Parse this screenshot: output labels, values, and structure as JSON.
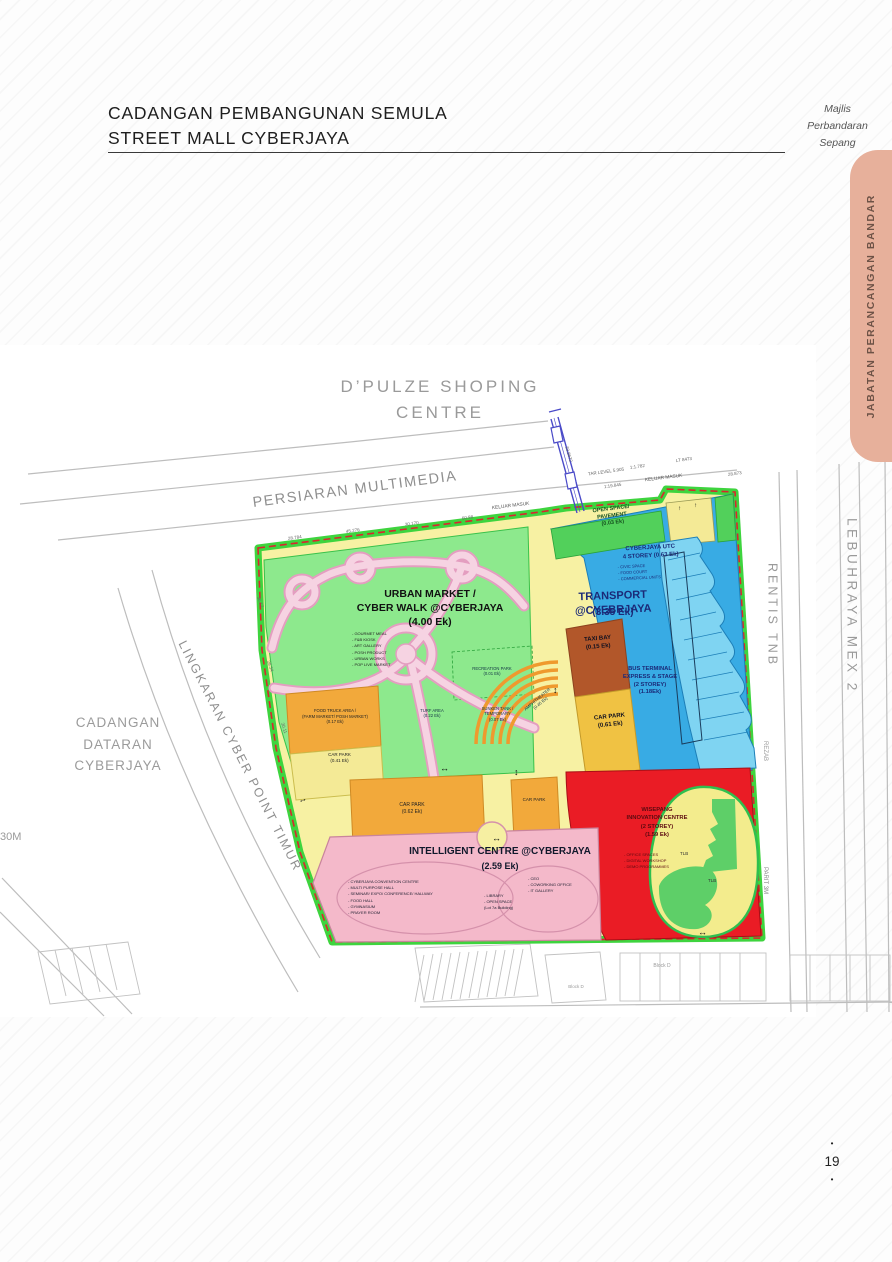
{
  "page": {
    "number": "19",
    "bullet": "•"
  },
  "header": {
    "title_line1": "CADANGAN PEMBANGUNAN SEMULA",
    "title_line2": "STREET MALL CYBERJAYA",
    "org_line1": "Majlis",
    "org_line2": "Perbandaran",
    "org_line3": "Sepang"
  },
  "side_tab": {
    "label": "JABATAN PERANCANGAN BANDAR"
  },
  "colors": {
    "tab_salmon": "#e7b09b",
    "site_border_green": "#3ed43e",
    "boundary_dashed_red": "#d9262e",
    "zone_green": "#8de98d",
    "zone_blue": "#38abe4",
    "zone_red": "#ea1c25",
    "zone_pink": "#f4b9ca",
    "zone_orange": "#f2a93b",
    "road_yellow": "#f7f1a3",
    "taxi_brown": "#b2572a",
    "navy_text": "#1b2a78"
  },
  "map": {
    "dpulze": "D’PULZE  SHOPING\nCENTRE",
    "persiaran": "PERSIARAN  MULTIMEDIA",
    "lingkaran": "LINGKARAN  CYBER  POINT  TIMUR",
    "rentis": "RENTIS  TNB",
    "mex2": "LEBUHRAYA  MEX  2",
    "rezab": "REZAB",
    "parit": "PARIT 3M",
    "dataran": "CADANGAN\nDATARAN\nCYBERJAYA",
    "dim_30m": "30M",
    "keluar_masuk_1": "KELUAR MASUK",
    "keluar_masuk_2": "KELUAR MASUK",
    "open_space": "OPEN SPACE/\nPAVEMENT\n(0.03 Ek)",
    "utc": "CYBERJAYA UTC\n4 STOREY (0.63 Ek)",
    "utc_items": [
      "- CIVIC SPACE",
      "- FOOD COURT",
      "- COMMERCIAL UNITS"
    ],
    "transport": "TRANSPORT @CYEBRJAYA",
    "transport_area": "(3.35 Ek)",
    "taxi_bay": "TAXI BAY\n(0.15 Ek)",
    "car_park_strip": "CAR PARK\n(0.61 Ek)",
    "bus_terminal": "BUS TERMINAL\nEXPRESS & STAGE\n(2 STOREY)\n(1.18Ek)",
    "urban_market": "URBAN MARKET /\nCYBER WALK @CYBERJAYA\n(4.00 Ek)",
    "urban_items": [
      "- GOURMET MEAL",
      "- F&B KIOSK",
      "- ART GALLERY",
      "- POSH PRODUCT",
      "- URBAN WORKS",
      "- POP LIVE MARKET"
    ],
    "recreation_park": "RECREATION PARK\n(0.01 Ek)",
    "turf_area": "TURF AREA\n(0.22 Ek)",
    "sunken_tank": "SUNKEN TANK /\nTEMPORARY\n(0.07 Ek)",
    "amphitheater": "AMPHITHEATER\n(0.45 Ek)",
    "food_truck": "FOOD TRUCK AREA /\n(FARM MARKET/ POSH MARKET)\n(0.17 Ek)",
    "car_park_left": "CAR PARK\n(0.41 Ek)",
    "car_park_mid": "CAR PARK\n(0.62 Ek)",
    "car_park_small": "CAR PARK",
    "intelligent": "INTELLIGENT CENTRE @CYBERJAYA",
    "intelligent_area": "(2.59 Ek)",
    "intelligent_items_left": [
      "- CYBERJAYA CONVENTION CENTRE",
      "- MULTI PURPOSE HALL",
      "- SEMINAR/ EXPO/ CONFERENCE/ HALLWAY",
      "- FOOD HALL",
      "- GYMNASIUM",
      "- PRAYER ROOM"
    ],
    "intelligent_items_mid": [
      "- LIBRARY",
      "- OPEN SPACE",
      "(Lot 7a Building)"
    ],
    "intelligent_items_right": [
      "- CEO",
      "- COWORKING OFFICE",
      "- IT GALLERY"
    ],
    "innovation": "WISEPANG\nINNOVATION CENTRE\n(2 STOREY)\n(1.59 Ek)",
    "innovation_items": [
      "- OFFICE SPACES",
      "- DIGITAL WORKSHOP",
      "- DEMO PROGRAMMES"
    ],
    "tlb_1": "TLB",
    "tlb_2": "TLB",
    "block_d_1": "Block D",
    "block_d_2": "Block D",
    "dims": [
      "28.784",
      "45.276",
      "30.170",
      "60.88",
      "33.8672",
      "TAR LEVEL 5.905",
      "1:1.782",
      "LT 8473",
      "1:19.845",
      "28.873",
      "36.17",
      "28.34",
      "30.11"
    ],
    "arrow_h": "↔",
    "arrow_v": "↕",
    "arrow_u": "↑"
  }
}
